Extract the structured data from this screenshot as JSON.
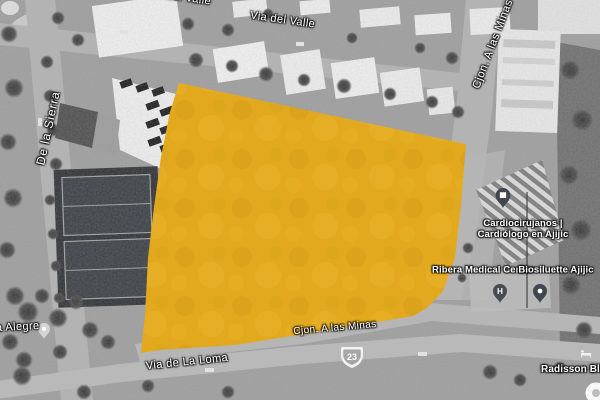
{
  "map": {
    "streets": {
      "via_del_valle_top": "Via del Valle",
      "via_del_valle": "Via del Valle",
      "de_la_sierra": "De la Sierra",
      "cjon_a_las_minas_vertical": "Cjon. A las Minas",
      "cjon_a_las_minas": "Cjon. A las Minas",
      "via_de_la_loma": "Via de La Loma",
      "calle_alegre_partial": "a Alegre"
    },
    "highway_shield": {
      "number": "23"
    },
    "pois": {
      "cardio": {
        "line1": "Cardiocirujanos |",
        "line2": "Cardiólogo en Ajijic"
      },
      "medical_center": "Ribera Medical Center",
      "biosiluette": "Biosiluette Ajijic",
      "radisson": "Radisson Blu A",
      "hospital_pin_glyph": "H"
    },
    "parcel": {
      "fill_color": "#E3A91E"
    }
  }
}
